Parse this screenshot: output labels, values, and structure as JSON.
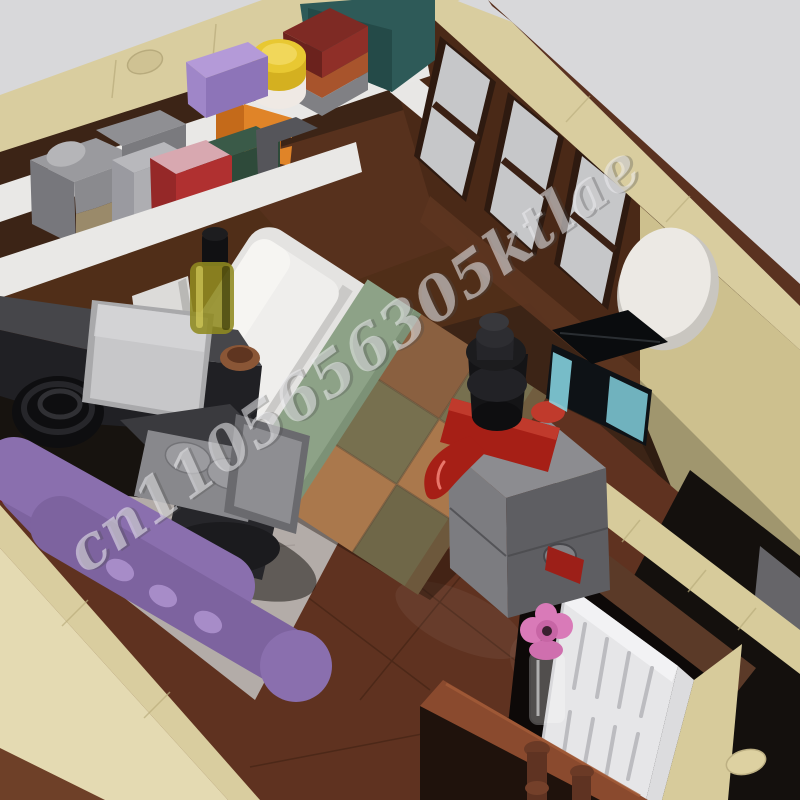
{
  "meta": {
    "description": "3D rendered product photo: LEGO-style MOC brick-built bedroom interior, isometric cutaway view, watermarked",
    "width_px": 800,
    "height_px": 800
  },
  "watermark": {
    "text": "cn1105656305ktlae",
    "style": "embossed silver script, diagonal",
    "rotation_deg": -35.5
  },
  "palette": {
    "background": "#d8d8da",
    "wall_tan": "#d9cd9f",
    "wall_tan_light": "#e4dab2",
    "wall_tan_partition": "#d7cb9b",
    "wall_face_right": "#cdc08e",
    "interior_dark_brown": "#3c2416",
    "wall_face_brown": "#4a2917",
    "window_rail_brown": "#5a3220",
    "window_pane_gray": "#c6c7c9",
    "floor_brown": "#5f3220",
    "floor_edge": "#8a4a2e",
    "rug_gray": "#b3aca8",
    "shelf_white": "#e9e8e6",
    "bed_white": "#e4e3e1",
    "pillow_white": "#efeeec",
    "blanket_green": "#8da287",
    "quilt_olive": "#77704f",
    "quilt_tan": "#aa784c",
    "quilt_brown": "#8a6040",
    "quilt_dark_olive": "#6f6748",
    "sofa_purple": "#8a6fae",
    "chair_gray": "#88888c",
    "chair_back_gray": "#8e8e92",
    "desk_dark_gray": "#46464a",
    "laptop_gray": "#c7c7c9",
    "dresser_gray": "#7c7c80",
    "ship_red": "#a61f16",
    "funnel_black": "#141416",
    "tank_cyan": "#8adbe8",
    "door_white": "#e6e6e8",
    "flower_pink": "#d97ab8",
    "bottle_yellow": "#8f8a20",
    "mirror_white": "#ece9e4",
    "box_purple": "#9f86c8",
    "box_yellow": "#e8c832",
    "box_dark_red": "#7e2a24",
    "box_rust": "#a8542c",
    "box_teal": "#2e5a58",
    "box_orange": "#e08428",
    "box_blue": "#2a4a9a",
    "box_green_dark": "#2e4a3a",
    "box_crimson": "#b03030",
    "baluster_brown": "#6b3a26"
  },
  "scene": {
    "objects": [
      {
        "name": "back-wall-shelf-with-storage-boxes",
        "color": "#e9e8e6"
      },
      {
        "name": "windows-with-dark-frames",
        "color": "#c6c7c9"
      },
      {
        "name": "round-wall-mirror",
        "color": "#ece9e4"
      },
      {
        "name": "bed-with-patchwork-quilt",
        "color": "#8da287"
      },
      {
        "name": "white-pillow",
        "color": "#efeeec"
      },
      {
        "name": "desk-with-laptop",
        "color": "#c7c7c9"
      },
      {
        "name": "swivel-desk-chair",
        "color": "#88888c"
      },
      {
        "name": "yellow-bottle",
        "color": "#8f8a20"
      },
      {
        "name": "purple-sofa",
        "color": "#8a6fae"
      },
      {
        "name": "gray-rug",
        "color": "#b3aca8"
      },
      {
        "name": "gray-dresser-nightstand",
        "color": "#7c7c80"
      },
      {
        "name": "toy-steamship",
        "color": "#a61f16"
      },
      {
        "name": "fish-tank",
        "color": "#8adbe8"
      },
      {
        "name": "doorway-with-white-door",
        "color": "#e6e6e8"
      },
      {
        "name": "pink-flower-vase",
        "color": "#d97ab8"
      },
      {
        "name": "glossy-wood-floor",
        "color": "#5f3220"
      },
      {
        "name": "stair-railing-balusters",
        "color": "#6b3a26"
      }
    ]
  }
}
